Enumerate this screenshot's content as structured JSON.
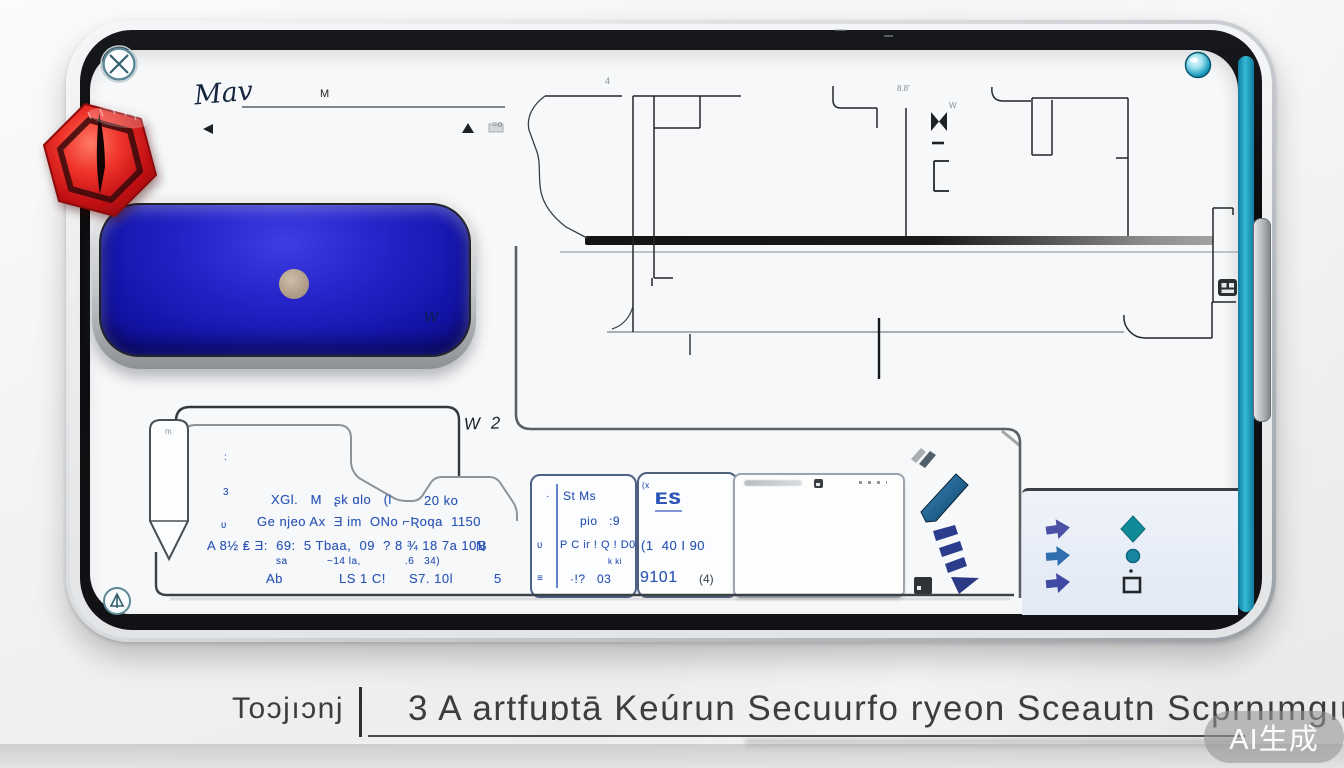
{
  "page": {
    "watermark": "AI生成",
    "caption": {
      "brand": "Toɔjıɔnj",
      "separator": "|",
      "title": "3 A artfuɒtā Keúrun Secuurfo ryeon Sceautn Scprnımgıuel"
    }
  },
  "device": {
    "colors": {
      "accent_teal": "#1a9cbe",
      "badge_red": "#d31216",
      "button_blue": "#1c1cc0",
      "ink_blue": "#2d55b5",
      "panel_blue": "#eef2fa"
    },
    "handwriting": {
      "word": "Mav",
      "line_label": "M"
    },
    "plan": {
      "label": "W 2",
      "dim_a": "8.8'",
      "dim_b": "4",
      "dim_c": "=o",
      "dim_d": "W"
    },
    "blue_button": {
      "mark": "W"
    },
    "notes": {
      "tab_mark": "m",
      "mark1": ":",
      "mark2": "3",
      "mark3": "ʋ",
      "row1a": "XGl.   M   ʂk ɑlo   (l",
      "row1b": "20 ko",
      "row2": "Ge njeo Ax  Ǝ im  ONo ⌐Ʀoqa  1150",
      "row3": "A 8½ ₤ Ǝ:  69:  5 Tbaa,  09  ? 8 ¾ 18 7a 10Ɓ",
      "row3n": "N",
      "row3b": "sa",
      "row3c": "~14 la,",
      "row3d": ".6   34)",
      "row4a": "Ab",
      "row4b": "LS 1 C!",
      "row4c": "S7. 10l",
      "row4d": "5"
    },
    "cardA": {
      "m1": "·",
      "m2": "ʋ",
      "m3": "≡",
      "l1": "St Ms",
      "l2": "pio   :9",
      "l3": "P C ir ! Q ! D0",
      "l3b": "k ki",
      "l4": "·!?   03"
    },
    "cardB": {
      "tiny": "(x",
      "l1": "ES",
      "l2": "(1  40 I 90",
      "l3": "9101",
      "l3e": "(4)"
    },
    "icons": [
      {
        "name": "circle-x-icon",
        "glyph": "⊗"
      },
      {
        "name": "triangle-gauge-icon",
        "glyph": "⟁"
      },
      {
        "name": "camera-lens-icon",
        "glyph": "◉"
      },
      {
        "name": "hexagon-pin-badge",
        "glyph": "⬡"
      },
      {
        "name": "chevron-slash-icon",
        "glyph": "⫽"
      },
      {
        "name": "pen-stroke-icon",
        "glyph": "╱"
      },
      {
        "name": "dashed-arrow-icon",
        "glyph": "⇘"
      },
      {
        "name": "mini-display-icon",
        "glyph": "▣"
      },
      {
        "name": "grid-icon",
        "glyph": "▤"
      },
      {
        "name": "arrow-right-icon",
        "glyph": "➤"
      },
      {
        "name": "diamond-icon",
        "glyph": "◆"
      },
      {
        "name": "dot-icon",
        "glyph": "●"
      },
      {
        "name": "square-outline-icon",
        "glyph": "□"
      }
    ]
  }
}
